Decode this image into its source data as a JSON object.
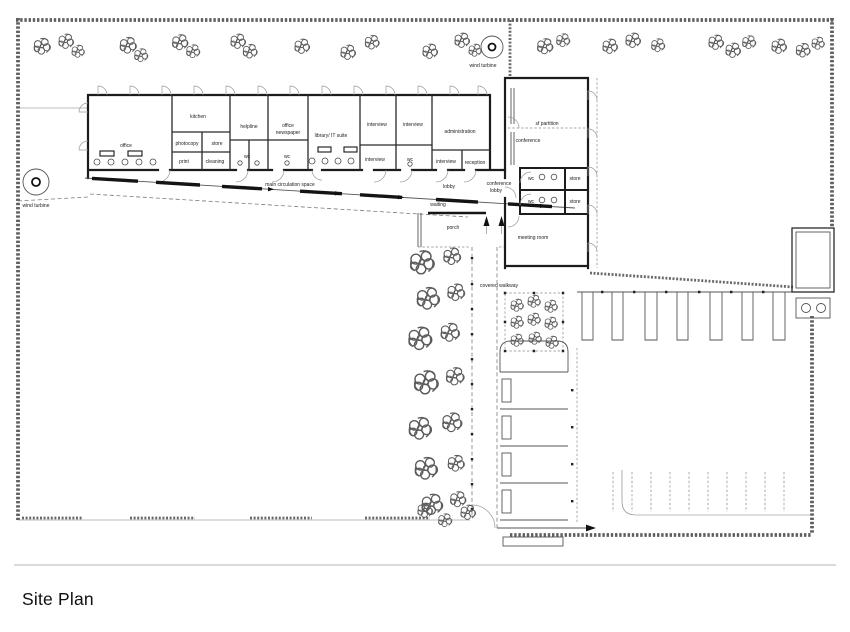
{
  "title": "Site Plan",
  "site": {
    "covered_walkway": "covered walkway",
    "wind_turbine_1": "wind turbine",
    "wind_turbine_2": "wind turbine"
  },
  "labels": {
    "office": "office",
    "kitchen": "kitchen",
    "photocopy": "photocopy",
    "store_1": "store",
    "print": "print",
    "cleaning": "cleaning",
    "wc_1": "wc",
    "wc_2": "wc",
    "helpline": "helpline",
    "office_2": "office",
    "newspaper": "newspaper",
    "library": "library/ IT suite",
    "interview_1": "interview",
    "interview_2": "interview",
    "administration": "administration",
    "interview_3": "interview",
    "wc_3": "wc",
    "interview_4": "interview",
    "reception": "reception",
    "circulation": "main circulation space",
    "lobby": "lobby",
    "waiting": "waiting",
    "porch": "porch",
    "conference_lobby_1": "conference",
    "conference_lobby_2": "lobby",
    "sf_partition": "sf partition",
    "conference": "conference",
    "wc_4": "wc",
    "store_2": "store",
    "wc_5": "wc",
    "store_3": "store",
    "meeting_room": "meeting room"
  }
}
